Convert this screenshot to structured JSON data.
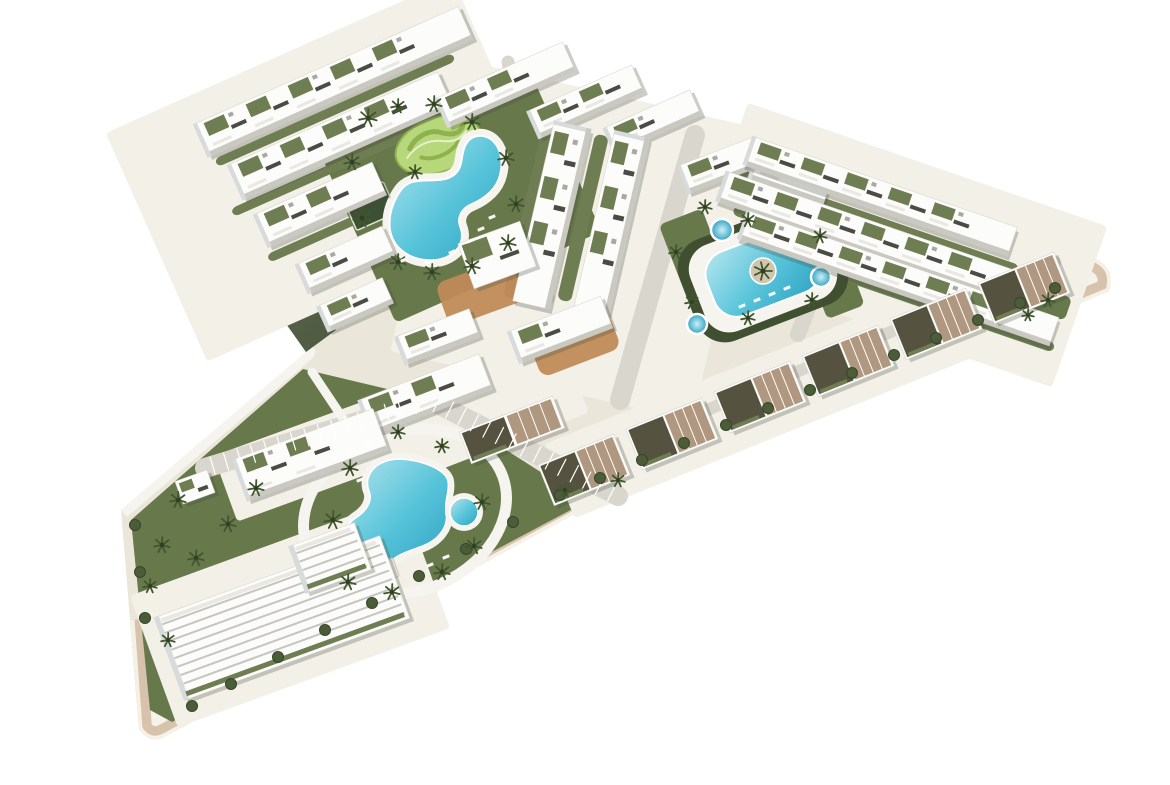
{
  "scene": {
    "title": "Aerial 3D architectural rendering of a residential complex",
    "description": "Bird's-eye 3D render of an angular arrow-shaped residential development on a white background: rows of white low-rise apartment buildings with olive roof gardens, a large lagoon pool with a mini-golf island, an oval pool with a palm island and round spas, a freeform pool in the lower garden wedge, palm trees, hedges, terracotta landscaping and beige perimeter sidewalks."
  },
  "colors": {
    "bg": "#ffffff",
    "plate": "#ebe6da",
    "plateLight": "#f3f0e8",
    "sidewalk": "#f5f2ea",
    "beige": "#d7c3ab",
    "rim": "#f6f1e7",
    "olive1": "#6b7558",
    "olive2": "#4d5941",
    "bevel": "#c8c4b8",
    "road": "#d9d6cd",
    "roadLight": "#e7e4db",
    "pathWhite": "#f6f4ee",
    "garden": "#67784b",
    "gardenDark": "#4e5e3b",
    "hedge": "#3f4f2f",
    "roofGreen": "#6e7d52",
    "golf": "#b7d77b",
    "golfDark": "#8fb24f",
    "golfPath": "#e6f0c9",
    "poolLight": "#b5e6ef",
    "pool": "#56c3d9",
    "poolDeep": "#2fa3c2",
    "terracotta": "#c08a57",
    "bldg": "#fcfcfa",
    "bldgShade": "#c9c8c1",
    "bldgFace": "#d8dbdc",
    "windowDark": "#4b4b46",
    "terraceTan": "#b0977f",
    "terraceDark": "#55523f",
    "railing": "#e9e8e2",
    "ac": "#a9a8a2",
    "treeDark": "#2f4024",
    "palm": "#42562f",
    "bush": "#4a5c38",
    "bushEdge": "#36462a",
    "court": "#3c5134",
    "courtLine": "#dfe5d2",
    "shadow": "rgba(70,75,60,0.28)",
    "poolHouse": "#e8e5dc"
  },
  "site": {
    "outline": "M 350 26 L 1093 258 Q 1116 267 1109 291 L 578 512 L 166 736 Q 150 745 139 729 L 121 510 L 306 352 L 172 163 Z",
    "se_edge": "M 1093 258 Q 1116 267 1109 291 L 578 512 L 166 736 Q 150 745 139 729 L 131 620",
    "left_edge": "M 121 510 L 306 352 L 172 163",
    "top_edge": "M 350 26 L 1093 258",
    "bevel_edge": "M 172 163 L 350 26",
    "olive_face": "172,163 306,352 336,330 204,146",
    "wedge_garden": "M 150 710 L 131 520 L 303 369 L 425 398 L 572 492 L 580 505 L 172 722 Z"
  },
  "groundPatches": [
    [
      330,
      170,
      380,
      250,
      -24
    ],
    [
      575,
      240,
      310,
      300,
      13
    ],
    [
      900,
      245,
      380,
      170,
      19
    ],
    [
      810,
      380,
      540,
      80,
      -22
    ],
    [
      470,
      410,
      220,
      90,
      -21
    ],
    [
      310,
      458,
      180,
      70,
      -20
    ],
    [
      290,
      612,
      290,
      140,
      -20
    ]
  ],
  "gardens": [
    {
      "r": [
        462,
        195,
        225,
        180,
        -24
      ],
      "fill": "garden"
    },
    {
      "r": [
        700,
        268,
        46,
        110,
        -21
      ],
      "fill": "garden"
    },
    {
      "r": [
        830,
        270,
        40,
        90,
        -21
      ],
      "fill": "garden"
    },
    {
      "r": [
        1038,
        299,
        64,
        24,
        19
      ],
      "fill": "garden"
    },
    {
      "r": [
        583,
        218,
        14,
        170,
        13
      ],
      "fill": "roofGreen"
    },
    {
      "r": [
        528,
        215,
        12,
        170,
        13
      ],
      "fill": "roofGreen"
    },
    {
      "r": [
        335,
        110,
        260,
        9,
        -24
      ],
      "fill": "roofGreen"
    },
    {
      "r": [
        333,
        168,
        220,
        9,
        -24
      ],
      "fill": "roofGreen"
    },
    {
      "r": [
        337,
        228,
        150,
        9,
        -24
      ],
      "fill": "roofGreen"
    },
    {
      "r": [
        876,
        221,
        300,
        10,
        19
      ],
      "fill": "roofGreen"
    },
    {
      "r": [
        885,
        262,
        320,
        10,
        19
      ],
      "fill": "roofGreen"
    },
    {
      "r": [
        912,
        299,
        300,
        10,
        19
      ],
      "fill": "roofGreen"
    }
  ],
  "terracotta": [
    [
      480,
      292,
      80,
      46,
      -20
    ],
    [
      575,
      345,
      85,
      38,
      -21
    ]
  ],
  "roads": [
    {
      "l": [
        695,
        135,
        620,
        400
      ],
      "w": 20
    },
    {
      "l": [
        842,
        222,
        798,
        334
      ],
      "w": 16
    },
    {
      "l": [
        660,
        430,
        1055,
        262
      ],
      "w": 12
    },
    {
      "l": [
        508,
        62,
        548,
        298
      ],
      "w": 13
    },
    {
      "l": [
        205,
        468,
        430,
        400
      ],
      "w": 20
    },
    {
      "l": [
        430,
        400,
        618,
        496
      ],
      "w": 20
    }
  ],
  "parking": [
    [
      205,
      468,
      430,
      400
    ],
    [
      430,
      400,
      618,
      496
    ]
  ],
  "whitePaths": [
    {
      "ellipse": [
        405,
        512,
        104,
        80,
        -20
      ],
      "w": 11
    },
    {
      "l": [
        312,
        372,
        352,
        432
      ],
      "w": 9
    }
  ],
  "golf": {
    "cx": 438,
    "cy": 145,
    "rx": 44,
    "ry": 27,
    "rot": -20
  },
  "court": [
    370,
    206,
    44,
    34,
    -24
  ],
  "pools": {
    "lagoon": "M 397 196 C 387 214 386 236 400 249 C 414 262 438 264 452 254 C 462 247 464 236 460 226 C 457 217 462 208 472 204 C 486 198 497 188 500 175 C 504 160 500 147 492 140 C 483 133 471 135 466 144 C 460 154 464 166 455 174 C 444 184 425 178 412 182 C 404 185 401 189 397 196 Z",
    "wedge": "M 390 460 C 372 464 364 478 369 491 C 373 501 366 511 357 517 C 343 526 338 545 348 558 C 358 571 379 573 390 562 C 398 554 409 551 420 547 C 438 541 449 527 446 512 C 444 501 450 492 448 481 C 445 466 407 456 390 460 Z",
    "island": {
      "hedge": [
        763,
        272,
        160,
        108,
        -21
      ],
      "deck": [
        763,
        272,
        140,
        92,
        -21
      ],
      "water": [
        763,
        272,
        112,
        68,
        -21
      ],
      "islandC": [
        763,
        271,
        13
      ]
    },
    "round": {
      "c": [
        464,
        512
      ],
      "r": 14
    },
    "spas": [
      [
        722,
        230,
        11
      ],
      [
        697,
        324,
        10
      ],
      [
        821,
        277,
        10
      ]
    ],
    "poolHouse": [
      382,
      572,
      30,
      20,
      -20
    ]
  },
  "buildings": [
    [
      333,
      82,
      290,
      36,
      -24,
      "row"
    ],
    [
      340,
      136,
      230,
      38,
      -24,
      "row"
    ],
    [
      320,
      205,
      130,
      36,
      -24,
      "row"
    ],
    [
      345,
      260,
      95,
      32,
      -24,
      "row"
    ],
    [
      355,
      305,
      72,
      28,
      -24,
      "row"
    ],
    [
      505,
      85,
      140,
      32,
      -24,
      "row"
    ],
    [
      585,
      102,
      115,
      30,
      -24,
      "row"
    ],
    [
      652,
      122,
      95,
      28,
      -24,
      "row"
    ],
    [
      552,
      215,
      38,
      185,
      13,
      "slab"
    ],
    [
      612,
      222,
      36,
      180,
      13,
      "slab"
    ],
    [
      497,
      255,
      66,
      48,
      -20,
      "block"
    ],
    [
      560,
      330,
      100,
      34,
      -21,
      "row"
    ],
    [
      437,
      337,
      80,
      30,
      -21,
      "row"
    ],
    [
      722,
      165,
      85,
      30,
      -21,
      "row"
    ],
    [
      790,
      178,
      80,
      28,
      19,
      "row"
    ],
    [
      880,
      196,
      280,
      30,
      19,
      "row"
    ],
    [
      872,
      238,
      320,
      32,
      19,
      "row"
    ],
    [
      898,
      278,
      330,
      30,
      19,
      "row"
    ],
    [
      1024,
      288,
      82,
      44,
      -22,
      "terrace"
    ],
    [
      936,
      324,
      82,
      44,
      -22,
      "terrace"
    ],
    [
      848,
      361,
      82,
      44,
      -22,
      "terrace"
    ],
    [
      760,
      397,
      82,
      44,
      -22,
      "terrace"
    ],
    [
      672,
      434,
      82,
      44,
      -22,
      "terrace"
    ],
    [
      584,
      470,
      82,
      44,
      -22,
      "terrace"
    ],
    [
      425,
      395,
      130,
      38,
      -21,
      "row"
    ],
    [
      512,
      430,
      100,
      34,
      -21,
      "terrace"
    ],
    [
      310,
      455,
      150,
      44,
      -20,
      "row"
    ],
    [
      282,
      618,
      240,
      88,
      -20,
      "wedge"
    ],
    [
      330,
      558,
      70,
      50,
      -20,
      "wedge"
    ],
    [
      195,
      487,
      34,
      24,
      -20,
      "block"
    ]
  ],
  "trees": [
    [
      368,
      118,
      9
    ],
    [
      352,
      162,
      8
    ],
    [
      362,
      218,
      9
    ],
    [
      398,
      262,
      8
    ],
    [
      432,
      272,
      8
    ],
    [
      472,
      266,
      8
    ],
    [
      508,
      243,
      8
    ],
    [
      516,
      204,
      8
    ],
    [
      506,
      158,
      8
    ],
    [
      472,
      122,
      8
    ],
    [
      434,
      104,
      8
    ],
    [
      398,
      106,
      7
    ],
    [
      415,
      172,
      7
    ],
    [
      705,
      207,
      7
    ],
    [
      676,
      252,
      7
    ],
    [
      692,
      302,
      7
    ],
    [
      748,
      318,
      7
    ],
    [
      812,
      300,
      7
    ],
    [
      820,
      236,
      7
    ],
    [
      748,
      220,
      7
    ],
    [
      350,
      468,
      8
    ],
    [
      333,
      520,
      9
    ],
    [
      348,
      582,
      8
    ],
    [
      392,
      592,
      8
    ],
    [
      442,
      572,
      8
    ],
    [
      474,
      546,
      8
    ],
    [
      482,
      502,
      8
    ],
    [
      442,
      446,
      7
    ],
    [
      398,
      432,
      7
    ],
    [
      178,
      500,
      8
    ],
    [
      162,
      545,
      8
    ],
    [
      196,
      558,
      8
    ],
    [
      228,
      524,
      8
    ],
    [
      256,
      488,
      8
    ],
    [
      150,
      586,
      7
    ],
    [
      168,
      640,
      7
    ],
    [
      565,
      490,
      7
    ],
    [
      618,
      480,
      7
    ],
    [
      1048,
      300,
      7
    ],
    [
      1028,
      315,
      6
    ]
  ],
  "bushes": [
    [
      600,
      478
    ],
    [
      642,
      460
    ],
    [
      684,
      443
    ],
    [
      726,
      425
    ],
    [
      768,
      408
    ],
    [
      810,
      390
    ],
    [
      852,
      373
    ],
    [
      894,
      355
    ],
    [
      936,
      338
    ],
    [
      978,
      320
    ],
    [
      1020,
      303
    ],
    [
      1055,
      288
    ],
    [
      560,
      495
    ],
    [
      513,
      522
    ],
    [
      466,
      549
    ],
    [
      419,
      576
    ],
    [
      372,
      603
    ],
    [
      325,
      630
    ],
    [
      278,
      657
    ],
    [
      231,
      684
    ],
    [
      192,
      706
    ],
    [
      135,
      525
    ],
    [
      140,
      572
    ],
    [
      145,
      618
    ]
  ],
  "loungers": [
    [
      470,
      241
    ],
    [
      481,
      229
    ],
    [
      492,
      217
    ],
    [
      452,
      252
    ],
    [
      428,
      262
    ],
    [
      404,
      260
    ],
    [
      742,
      306
    ],
    [
      757,
      300
    ],
    [
      772,
      294
    ],
    [
      787,
      288
    ],
    [
      352,
      452
    ],
    [
      368,
      444
    ],
    [
      430,
      565
    ],
    [
      446,
      557
    ],
    [
      360,
      480
    ]
  ]
}
